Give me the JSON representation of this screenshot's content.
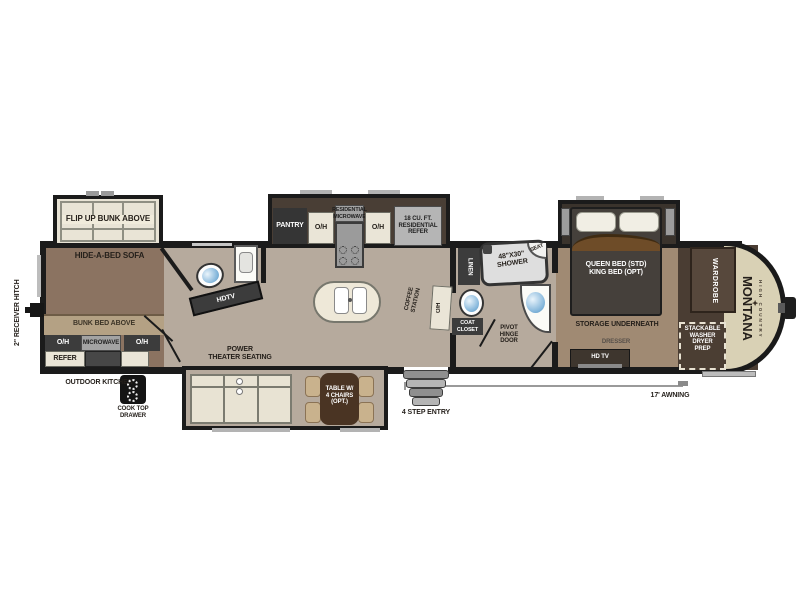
{
  "plan": {
    "hitch_label": "2\" RECEIVER HITCH",
    "oh": "O/H",
    "rear_slide": {
      "flip_bunk": "FLIP UP BUNK ABOVE"
    },
    "bunk_room": {
      "sofa": "HIDE-A-BED SOFA",
      "bunk_strip": "BUNK BED ABOVE",
      "microwave": "MICROWAVE",
      "refer": "REFER",
      "outdoor_kitchen": "OUTDOOR KITCHEN",
      "cooktop": "COOK TOP\nDRAWER"
    },
    "mid_bath": {
      "tv": "HDTV"
    },
    "kitchen_slide": {
      "pantry": "PANTRY",
      "res_microwave": "RESIDENTIAL\nMICROWAVE",
      "refer": "18 CU. FT.\nRESIDENTIAL\nREFER"
    },
    "galley": {
      "coffee": "COFFEE\nSTATION"
    },
    "living": {
      "theater": "POWER\nTHEATER SEATING",
      "table": "TABLE W/\n4 CHAIRS\n(OPT.)"
    },
    "bath": {
      "linen": "LINEN",
      "shower": "48\"X30\"\nSHOWER",
      "seat": "SEAT",
      "coat_closet": "COAT\nCLOSET",
      "pivot_door": "PIVOT\nHINGE\nDOOR"
    },
    "entry": {
      "steps": "4 STEP ENTRY"
    },
    "bedroom": {
      "bed": "QUEEN BED (STD)\nKING BED (OPT)",
      "storage": "STORAGE  UNDERNEATH",
      "dresser": "DRESSER",
      "hdtv": "HD TV",
      "wardrobe": "WARDROBE",
      "stackable": "STACKABLE\nWASHER\nDRYER\nPREP"
    },
    "exterior": {
      "awning": "17' AWNING",
      "brand": "MONTANA",
      "brand_sub": "HIGH COUNTRY",
      "ornament": "✦"
    }
  },
  "colors": {
    "wall": "#1b1b1b",
    "bunk_floor": "#8b7361",
    "living_floor": "#b6aa9d",
    "bedroom_floor": "#a08a73",
    "front_dark": "#4a3d33",
    "cap_cream": "#d9d1b5",
    "accent_tan": "#b4a184",
    "table_brown": "#4a3423",
    "chair_tan": "#c9b28d"
  }
}
